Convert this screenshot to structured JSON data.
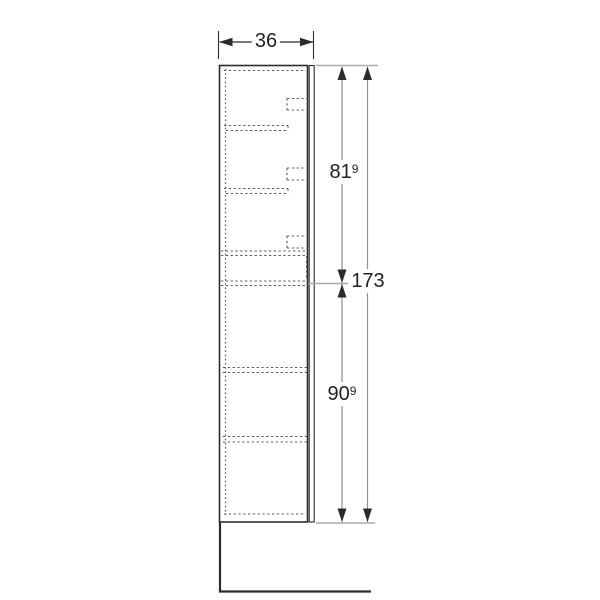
{
  "drawing": {
    "kind": "furniture-dimension-side-elevation",
    "subject": "tall-cabinet-profile-with-shelves-and-hinges",
    "dimensions": {
      "width": {
        "value": "36",
        "sup": ""
      },
      "upper_height": {
        "value": "81",
        "sup": "9"
      },
      "total_height": {
        "value": "173",
        "sup": ""
      },
      "lower_height": {
        "value": "90",
        "sup": "9"
      }
    }
  },
  "colors": {
    "line-dark": "#2d2b2c",
    "line-hidden": "#5a5b5e",
    "line-ext": "#a8aaad",
    "line-dim": "#8e9092",
    "text": "#231f20",
    "bg": "#ffffff"
  }
}
